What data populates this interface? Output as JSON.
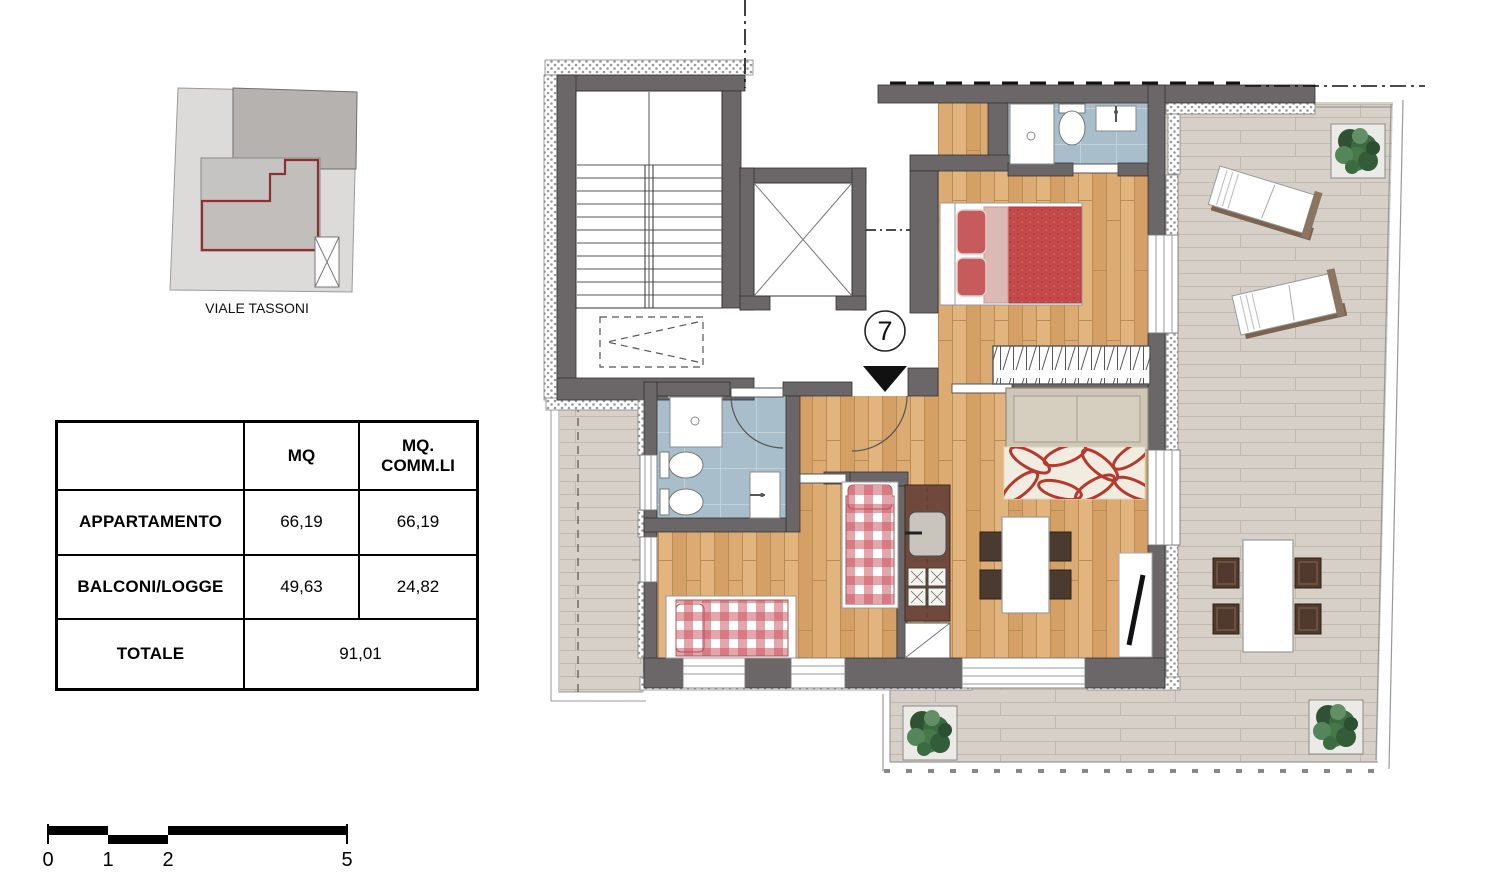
{
  "site_plan": {
    "street_label": "VIALE TASSONI"
  },
  "area_table": {
    "col_headers": [
      "",
      "MQ",
      "MQ. COMM.LI"
    ],
    "rows": [
      {
        "label": "APPARTAMENTO",
        "mq": "66,19",
        "mq_commli": "66,19"
      },
      {
        "label": "BALCONI/LOGGE",
        "mq": "49,63",
        "mq_commli": "24,82"
      }
    ],
    "total": {
      "label": "TOTALE",
      "value": "91,01"
    }
  },
  "floor_plan": {
    "unit_number": "7"
  },
  "scale_bar": {
    "labels": [
      "0",
      "1",
      "2",
      "5"
    ],
    "unit": "m"
  },
  "colors": {
    "wall": "#6b6667",
    "wood_floor": "#d9aa72",
    "bath_floor": "#a9becb",
    "terrace_tile": "#d6d0c8",
    "apartment_outline_red": "#8e3030",
    "bed_red": "#c4494b",
    "gingham_red": "#c94d57",
    "plant_green": "#3c6b41"
  }
}
